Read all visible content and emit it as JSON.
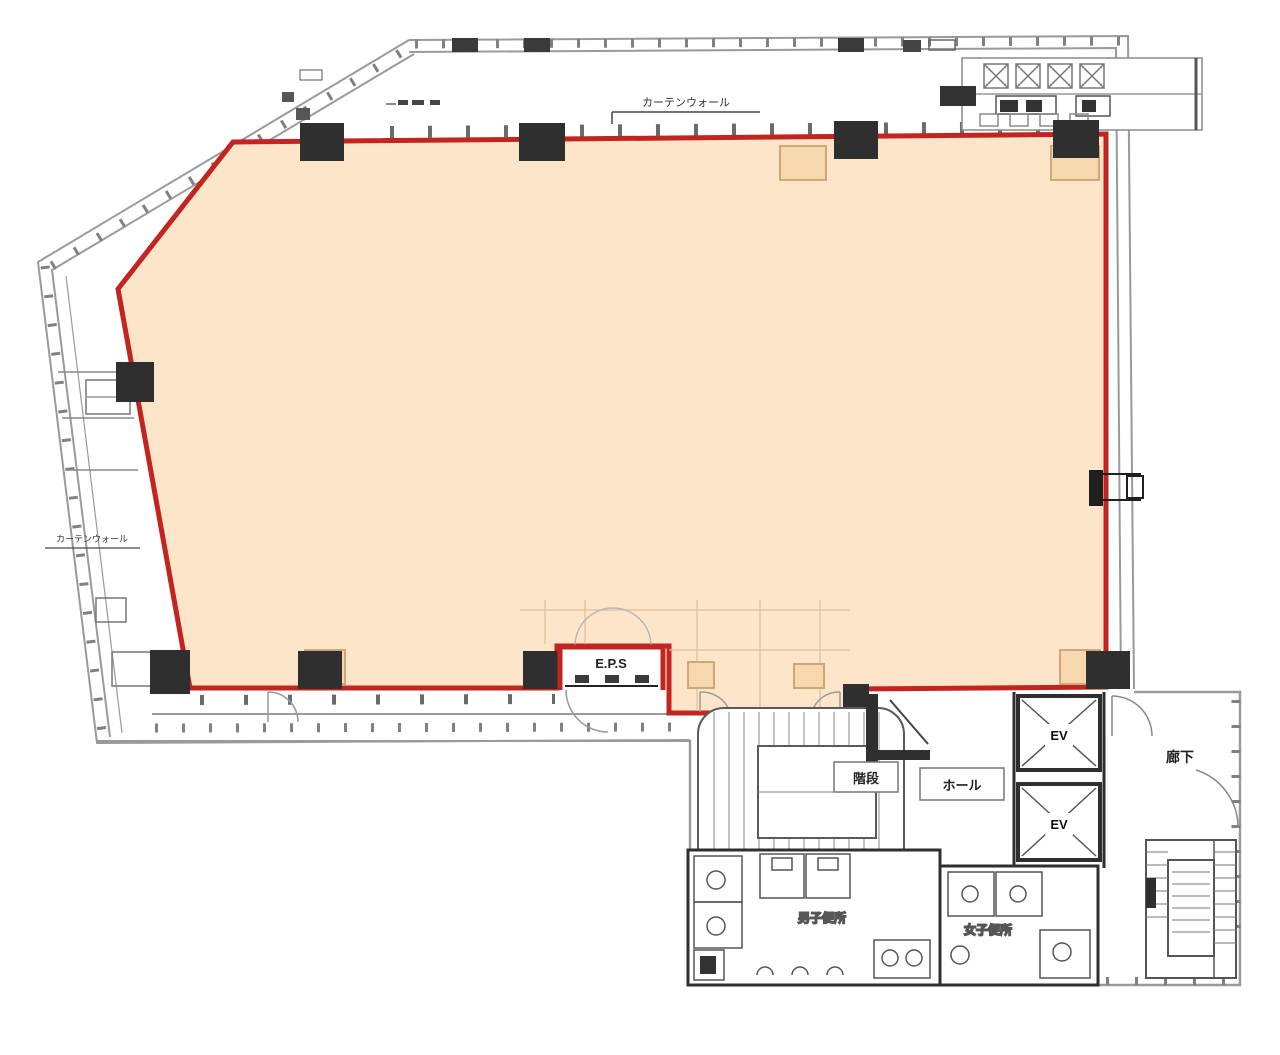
{
  "plan": {
    "annotations": {
      "curtain_wall_top": "カーテンウォール",
      "curtain_wall_left": "カーテンウォール"
    },
    "rooms": {
      "eps": "E.P.S",
      "stairs": "階段",
      "hall": "ホール",
      "elevator_1": "EV",
      "elevator_2": "EV",
      "corridor": "廊下",
      "mens_toilet": "男子便所",
      "womens_toilet": "女子便所"
    },
    "colors": {
      "leasable_area_fill": "#fce5c9",
      "boundary_red": "#c3241f",
      "linework_gray": "#9a9a9a",
      "linework_dark": "#2f2f2f",
      "linework_tan": "#cfa878"
    }
  }
}
